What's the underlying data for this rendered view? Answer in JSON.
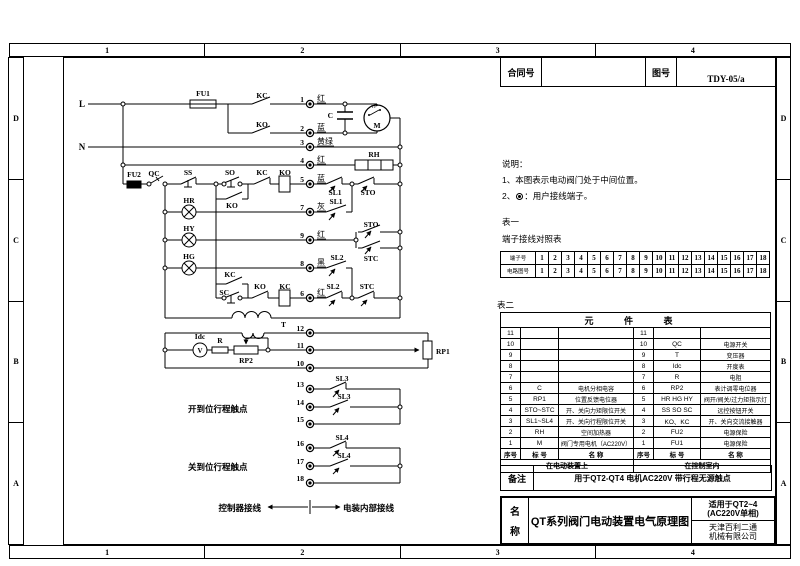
{
  "zones": {
    "cols": [
      "1",
      "2",
      "3",
      "4"
    ],
    "rows": [
      "D",
      "C",
      "B",
      "A"
    ]
  },
  "header_box": {
    "contract_label": "合同号",
    "drawing_label": "图号",
    "drawing_no": "TDY-05/a"
  },
  "notes": {
    "title": "说明：",
    "item1": "1、本图表示电动阀门处于中间位置。",
    "item2_prefix": "2、",
    "item2_suffix": "：用户接线端子。"
  },
  "table1": {
    "caption": "表一",
    "subtitle": "端子接线对照表",
    "row1_label": "端子号",
    "row2_label": "电路图号",
    "row1": [
      "1",
      "2",
      "3",
      "4",
      "5",
      "6",
      "7",
      "8",
      "9",
      "10",
      "11",
      "12",
      "13",
      "14",
      "15",
      "16",
      "17",
      "18"
    ],
    "row2": [
      "1",
      "2",
      "3",
      "4",
      "5",
      "6",
      "7",
      "8",
      "9",
      "10",
      "11",
      "12",
      "13",
      "14",
      "15",
      "16",
      "17",
      "18"
    ]
  },
  "table2": {
    "caption": "表二",
    "title": "元 件 表",
    "rows": [
      [
        "11",
        "",
        "",
        "11",
        "",
        ""
      ],
      [
        "10",
        "",
        "",
        "10",
        "QC",
        "电源开关"
      ],
      [
        "9",
        "",
        "",
        "9",
        "T",
        "变压器"
      ],
      [
        "8",
        "",
        "",
        "8",
        "Idc",
        "开度表"
      ],
      [
        "7",
        "",
        "",
        "7",
        "R",
        "电阻"
      ],
      [
        "6",
        "C",
        "电机分相电容",
        "6",
        "RP2",
        "表计调零电位器"
      ],
      [
        "5",
        "RP1",
        "位置反馈电位器",
        "5",
        "HR HG HY",
        "阀开/阀关/过力矩指示灯"
      ],
      [
        "4",
        "STO~STC",
        "开、关向力矩限位开关",
        "4",
        "SS SO SC",
        "远控按钮开关"
      ],
      [
        "3",
        "SL1~SL4",
        "开、关向行程限位开关",
        "3",
        "KO、KC",
        "开、关向交流接触器"
      ],
      [
        "2",
        "RH",
        "空间加热器",
        "2",
        "FU2",
        "电源保险"
      ],
      [
        "1",
        "M",
        "阀门专用电机（AC220V）",
        "1",
        "FU1",
        "电源保险"
      ]
    ],
    "header": [
      "序号",
      "标 号",
      "名  称",
      "序号",
      "标 号",
      "名  称"
    ],
    "footer_left": "在电动装置上",
    "footer_right": "在控制室内"
  },
  "remark": {
    "label": "备注",
    "text": "用于QT2-QT4  电机AC220V  带行程无源触点"
  },
  "titleblock": {
    "name_top": "名",
    "name_bottom": "称",
    "title": "QT系列阀门电动装置电气原理图",
    "apply_line1": "适用于QT2~4",
    "apply_line2": "(AC220V单相)",
    "company_line1": "天津百利二通",
    "company_line2": "机械有限公司"
  },
  "schematic": {
    "comp": {
      "L": "L",
      "N": "N",
      "FU1": "FU1",
      "FU2": "FU2",
      "QC": "QC",
      "SS": "SS",
      "SO": "SO",
      "SC": "SC",
      "KC": "KC",
      "KO": "KO",
      "SL1": "SL1",
      "SL2": "SL2",
      "SL3": "SL3",
      "SL4": "SL4",
      "STO": "STO",
      "STC": "STC",
      "HR": "HR",
      "HY": "HY",
      "HG": "HG",
      "RH": "RH",
      "C": "C",
      "M": "M",
      "TP": "TP",
      "T": "T",
      "Idc": "Idc",
      "V": "V",
      "R": "R",
      "RP1": "RP1",
      "RP2": "RP2"
    },
    "colors": {
      "red": "红",
      "blue": "蓝",
      "yellow_green": "黄绿",
      "gray": "灰",
      "black": "黑"
    },
    "terms": [
      "1",
      "2",
      "3",
      "4",
      "5",
      "6",
      "7",
      "8",
      "9",
      "10",
      "11",
      "12",
      "13",
      "14",
      "15",
      "16",
      "17",
      "18"
    ],
    "open_group": "开到位行程触点",
    "close_group": "关到位行程触点",
    "ctrl_wiring": "控制器接线",
    "internal_wiring": "电装内部接线"
  }
}
